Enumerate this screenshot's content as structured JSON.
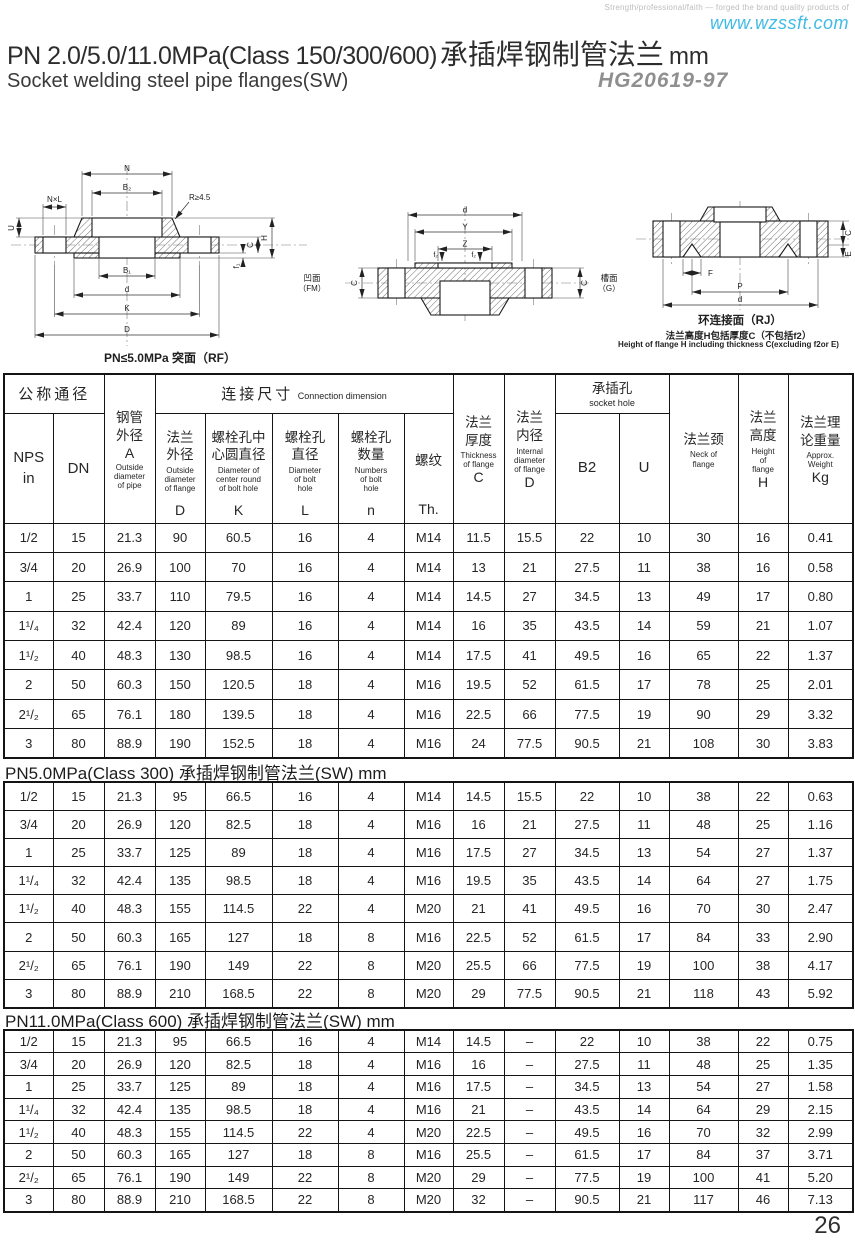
{
  "brand": {
    "tagline": "Strength/professional/faith — forged the brand quality products of",
    "website": "www.wzssft.com",
    "accent_color": "#41bbe6"
  },
  "header": {
    "title_en": "PN 2.0/5.0/11.0MPa(Class 150/300/600)",
    "title_cn": "承插焊钢制管法兰",
    "title_unit": "mm",
    "subtitle": "Socket welding steel pipe flanges(SW)",
    "standard_no": "HG20619-97"
  },
  "drawings": {
    "rf": {
      "caption": "PN≤5.0MPa 突面（RF）",
      "n": "N",
      "b2": "B₂",
      "r": "R≥4.5",
      "nxl": "N×L",
      "u": "U",
      "b1": "B₁",
      "d": "d",
      "k": "K",
      "big_d": "D",
      "f1": "f₁",
      "c": "C",
      "h": "H"
    },
    "fm": {
      "d": "d",
      "y": "Y",
      "z": "Z",
      "f2": "f₂",
      "c": "C",
      "left_cn": "凹面",
      "left_en": "（FM）",
      "right_cn": "槽面",
      "right_en": "（G）"
    },
    "rj": {
      "caption": "环连接面（RJ）",
      "f": "F",
      "p": "P",
      "d": "d",
      "c": "C",
      "e": "E",
      "note_cn": "法兰高度H包括厚度C（不包括f2）",
      "note_en": "Height of flange H including thickness C(excluding f2or E)"
    }
  },
  "table": {
    "group": {
      "nominal": "公称通径",
      "connection_cn": "连接尺寸",
      "connection_en": "Connection dimension",
      "socket_cn": "承插孔",
      "socket_en": "socket hole"
    },
    "cols": {
      "nps": "NPS\nin",
      "dn": "DN",
      "pipe_od_cn": "钢管\n外径",
      "pipe_od_letter": "A",
      "pipe_od_en": "Outside\ndiameter\nof pipe",
      "flange_od_cn": "法兰\n外径",
      "flange_od_en": "Outside\ndiameter\nof flange",
      "flange_od_letter": "D",
      "bolt_circle_cn": "螺栓孔中\n心圆直径",
      "bolt_circle_en": "Diameter of\ncenter round\nof bolt hole",
      "bolt_circle_letter": "K",
      "bolt_hole_cn": "螺栓孔\n直径",
      "bolt_hole_en": "Diameter\nof bolt\nhole",
      "bolt_hole_letter": "L",
      "bolt_num_cn": "螺栓孔\n数量",
      "bolt_num_en": "Numbers\nof bolt\nhole",
      "bolt_num_letter": "n",
      "thread_cn": "螺纹",
      "thread_letter": "Th.",
      "thickness_cn": "法兰\n厚度",
      "thickness_en": "Thickness\nof flange",
      "thickness_letter": "C",
      "inner_cn": "法兰\n内径",
      "inner_en": "Internal\ndiameter\nof flange",
      "inner_letter": "D",
      "b2": "B2",
      "u": "U",
      "neck_cn": "法兰颈",
      "neck_en": "Neck of\nflange",
      "height_cn": "法兰\n高度",
      "height_en": "Height\nof\nflange",
      "height_letter": "H",
      "weight_cn": "法兰理\n论重量",
      "weight_en": "Approx.\nWeight",
      "weight_letter": "Kg"
    },
    "sections": [
      {
        "title": "",
        "rows": [
          [
            "1/2",
            "15",
            "21.3",
            "90",
            "60.5",
            "16",
            "4",
            "M14",
            "11.5",
            "15.5",
            "22",
            "10",
            "30",
            "16",
            "0.41"
          ],
          [
            "3/4",
            "20",
            "26.9",
            "100",
            "70",
            "16",
            "4",
            "M14",
            "13",
            "21",
            "27.5",
            "11",
            "38",
            "16",
            "0.58"
          ],
          [
            "1",
            "25",
            "33.7",
            "110",
            "79.5",
            "16",
            "4",
            "M14",
            "14.5",
            "27",
            "34.5",
            "13",
            "49",
            "17",
            "0.80"
          ],
          [
            "1¹/₄",
            "32",
            "42.4",
            "120",
            "89",
            "16",
            "4",
            "M14",
            "16",
            "35",
            "43.5",
            "14",
            "59",
            "21",
            "1.07"
          ],
          [
            "1¹/₂",
            "40",
            "48.3",
            "130",
            "98.5",
            "16",
            "4",
            "M14",
            "17.5",
            "41",
            "49.5",
            "16",
            "65",
            "22",
            "1.37"
          ],
          [
            "2",
            "50",
            "60.3",
            "150",
            "120.5",
            "18",
            "4",
            "M16",
            "19.5",
            "52",
            "61.5",
            "17",
            "78",
            "25",
            "2.01"
          ],
          [
            "2¹/₂",
            "65",
            "76.1",
            "180",
            "139.5",
            "18",
            "4",
            "M16",
            "22.5",
            "66",
            "77.5",
            "19",
            "90",
            "29",
            "3.32"
          ],
          [
            "3",
            "80",
            "88.9",
            "190",
            "152.5",
            "18",
            "4",
            "M16",
            "24",
            "77.5",
            "90.5",
            "21",
            "108",
            "30",
            "3.83"
          ]
        ]
      },
      {
        "title": "PN5.0MPa(Class 300) 承插焊钢制管法兰(SW)  mm",
        "rows": [
          [
            "1/2",
            "15",
            "21.3",
            "95",
            "66.5",
            "16",
            "4",
            "M14",
            "14.5",
            "15.5",
            "22",
            "10",
            "38",
            "22",
            "0.63"
          ],
          [
            "3/4",
            "20",
            "26.9",
            "120",
            "82.5",
            "18",
            "4",
            "M16",
            "16",
            "21",
            "27.5",
            "11",
            "48",
            "25",
            "1.16"
          ],
          [
            "1",
            "25",
            "33.7",
            "125",
            "89",
            "18",
            "4",
            "M16",
            "17.5",
            "27",
            "34.5",
            "13",
            "54",
            "27",
            "1.37"
          ],
          [
            "1¹/₄",
            "32",
            "42.4",
            "135",
            "98.5",
            "18",
            "4",
            "M16",
            "19.5",
            "35",
            "43.5",
            "14",
            "64",
            "27",
            "1.75"
          ],
          [
            "1¹/₂",
            "40",
            "48.3",
            "155",
            "114.5",
            "22",
            "4",
            "M20",
            "21",
            "41",
            "49.5",
            "16",
            "70",
            "30",
            "2.47"
          ],
          [
            "2",
            "50",
            "60.3",
            "165",
            "127",
            "18",
            "8",
            "M16",
            "22.5",
            "52",
            "61.5",
            "17",
            "84",
            "33",
            "2.90"
          ],
          [
            "2¹/₂",
            "65",
            "76.1",
            "190",
            "149",
            "22",
            "8",
            "M20",
            "25.5",
            "66",
            "77.5",
            "19",
            "100",
            "38",
            "4.17"
          ],
          [
            "3",
            "80",
            "88.9",
            "210",
            "168.5",
            "22",
            "8",
            "M20",
            "29",
            "77.5",
            "90.5",
            "21",
            "118",
            "43",
            "5.92"
          ]
        ]
      },
      {
        "title": "PN11.0MPa(Class 600) 承插焊钢制管法兰(SW)  mm",
        "rows": [
          [
            "1/2",
            "15",
            "21.3",
            "95",
            "66.5",
            "16",
            "4",
            "M14",
            "14.5",
            "–",
            "22",
            "10",
            "38",
            "22",
            "0.75"
          ],
          [
            "3/4",
            "20",
            "26.9",
            "120",
            "82.5",
            "18",
            "4",
            "M16",
            "16",
            "–",
            "27.5",
            "11",
            "48",
            "25",
            "1.35"
          ],
          [
            "1",
            "25",
            "33.7",
            "125",
            "89",
            "18",
            "4",
            "M16",
            "17.5",
            "–",
            "34.5",
            "13",
            "54",
            "27",
            "1.58"
          ],
          [
            "1¹/₄",
            "32",
            "42.4",
            "135",
            "98.5",
            "18",
            "4",
            "M16",
            "21",
            "–",
            "43.5",
            "14",
            "64",
            "29",
            "2.15"
          ],
          [
            "1¹/₂",
            "40",
            "48.3",
            "155",
            "114.5",
            "22",
            "4",
            "M20",
            "22.5",
            "–",
            "49.5",
            "16",
            "70",
            "32",
            "2.99"
          ],
          [
            "2",
            "50",
            "60.3",
            "165",
            "127",
            "18",
            "8",
            "M16",
            "25.5",
            "–",
            "61.5",
            "17",
            "84",
            "37",
            "3.71"
          ],
          [
            "2¹/₂",
            "65",
            "76.1",
            "190",
            "149",
            "22",
            "8",
            "M20",
            "29",
            "–",
            "77.5",
            "19",
            "100",
            "41",
            "5.20"
          ],
          [
            "3",
            "80",
            "88.9",
            "210",
            "168.5",
            "22",
            "8",
            "M20",
            "32",
            "–",
            "90.5",
            "21",
            "117",
            "46",
            "7.13"
          ]
        ]
      }
    ]
  },
  "page_number": "26"
}
